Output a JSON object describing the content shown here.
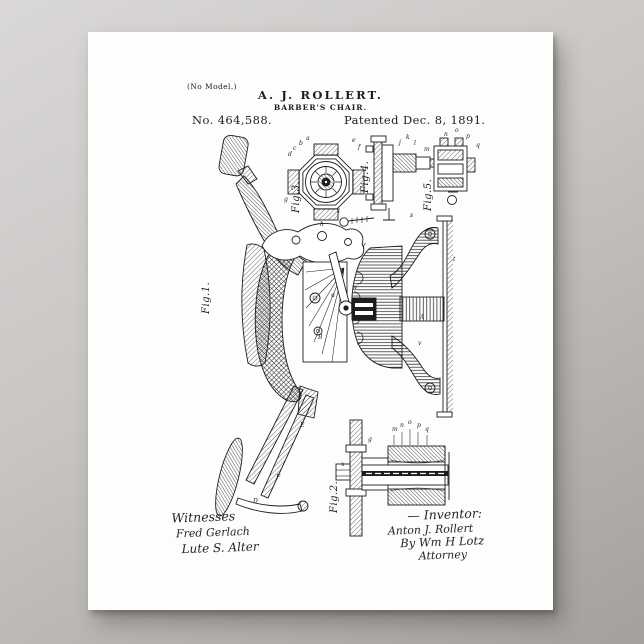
{
  "scene": {
    "background_top_color": "#dad8d7",
    "background_bottom_color": "#a3a09e",
    "paper_color": "#fdfdfc",
    "ink_color": "#1d1d1d"
  },
  "header": {
    "no_model": "(No Model.)",
    "inventor_name": "A. J. ROLLERT.",
    "invention_title": "BARBER'S CHAIR.",
    "patent_number": "No. 464,588.",
    "patent_date": "Patented Dec. 8, 1891."
  },
  "figures": {
    "fig1": "Fig.1.",
    "fig2": "Fig.2.",
    "fig3": "Fig.3.",
    "fig4": "Fig.4.",
    "fig5": "Fig.5."
  },
  "signatures": {
    "witnesses_heading": "Witnesses",
    "witness1": "Fred Gerlach",
    "witness2": "Lute S. Alter",
    "inventor_heading": "— Inventor:",
    "inventor_signature": "Anton J. Rollert",
    "attorney_by": "By Wm H Lotz",
    "attorney_label": "Attorney"
  },
  "reference_letters": [
    {
      "t": "a",
      "x": 306,
      "y": 140
    },
    {
      "t": "b",
      "x": 299,
      "y": 145
    },
    {
      "t": "c",
      "x": 293,
      "y": 150
    },
    {
      "t": "d",
      "x": 288,
      "y": 156
    },
    {
      "t": "e",
      "x": 352,
      "y": 142
    },
    {
      "t": "f",
      "x": 358,
      "y": 149
    },
    {
      "t": "g",
      "x": 284,
      "y": 201
    },
    {
      "t": "h",
      "x": 320,
      "y": 226
    },
    {
      "t": "i",
      "x": 338,
      "y": 213
    },
    {
      "t": "j",
      "x": 399,
      "y": 144
    },
    {
      "t": "k",
      "x": 406,
      "y": 139
    },
    {
      "t": "l",
      "x": 414,
      "y": 145
    },
    {
      "t": "m",
      "x": 424,
      "y": 151
    },
    {
      "t": "n",
      "x": 444,
      "y": 136
    },
    {
      "t": "o",
      "x": 455,
      "y": 132
    },
    {
      "t": "p",
      "x": 466,
      "y": 138
    },
    {
      "t": "q",
      "x": 476,
      "y": 147
    },
    {
      "t": "r",
      "x": 363,
      "y": 247
    },
    {
      "t": "s",
      "x": 410,
      "y": 217
    },
    {
      "t": "t",
      "x": 453,
      "y": 261
    },
    {
      "t": "A",
      "x": 420,
      "y": 319
    },
    {
      "t": "v",
      "x": 418,
      "y": 345
    },
    {
      "t": "B",
      "x": 318,
      "y": 339
    },
    {
      "t": "u",
      "x": 331,
      "y": 297
    },
    {
      "t": "w",
      "x": 352,
      "y": 289
    },
    {
      "t": "F",
      "x": 276,
      "y": 479
    },
    {
      "t": "E",
      "x": 300,
      "y": 427
    },
    {
      "t": "D",
      "x": 253,
      "y": 503
    },
    {
      "t": "m",
      "x": 392,
      "y": 431
    },
    {
      "t": "n",
      "x": 400,
      "y": 427
    },
    {
      "t": "o",
      "x": 408,
      "y": 424
    },
    {
      "t": "p",
      "x": 417,
      "y": 427
    },
    {
      "t": "q",
      "x": 425,
      "y": 431
    },
    {
      "t": "g",
      "x": 368,
      "y": 441
    },
    {
      "t": "x",
      "x": 341,
      "y": 466
    }
  ]
}
